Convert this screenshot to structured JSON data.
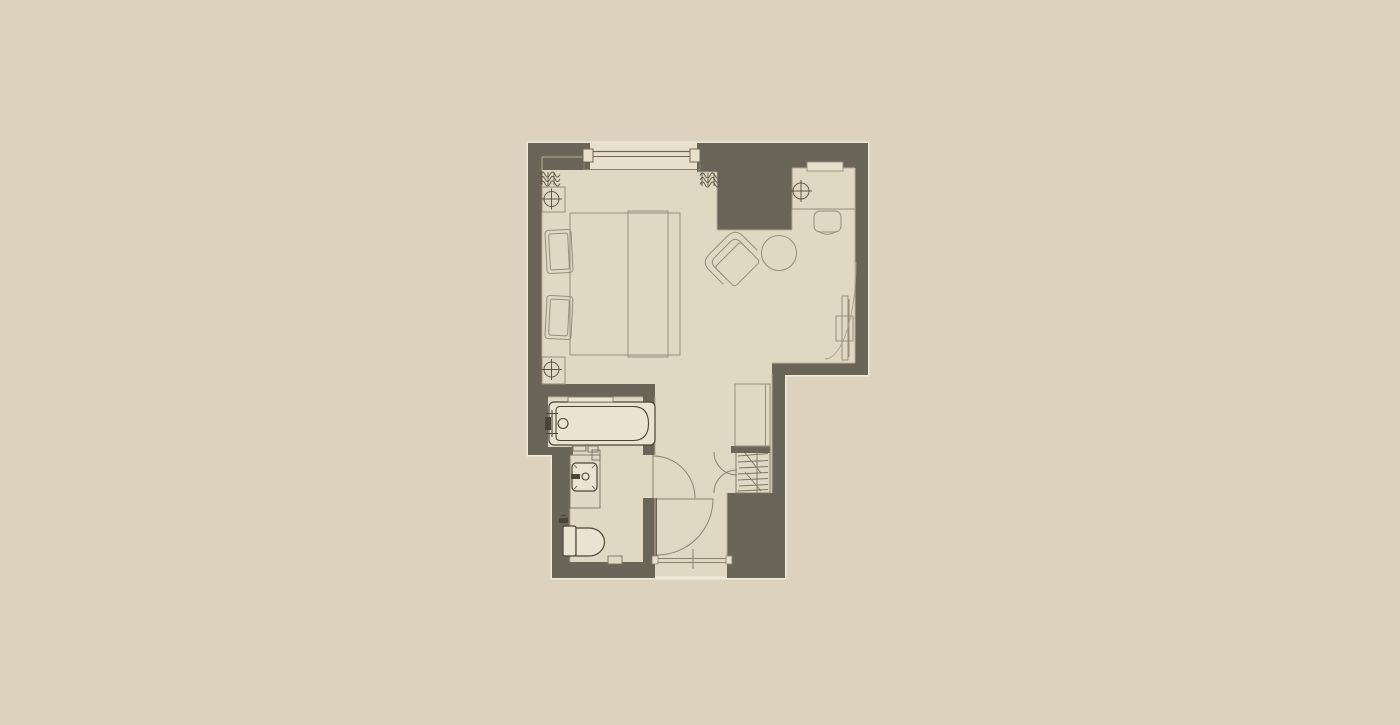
{
  "title": "Hotel guest room floor plan",
  "colors": {
    "bg": "#dcd2bd",
    "floor": "#e1d8c4",
    "floor-light": "#e8e0cd",
    "fixture": "#eae3d2",
    "wall": "#6b6459",
    "outline": "#efe9d8",
    "line": "#968c7a",
    "line-dark": "#4a4438",
    "door": "#8a8071",
    "detail": "#7a7162",
    "glyph": "#5f5748",
    "hairline": "#b7ac96"
  },
  "rooms": [
    {
      "name": "bedroom"
    },
    {
      "name": "bathroom"
    },
    {
      "name": "entry-hall"
    }
  ],
  "elements": {
    "bedroom": [
      "window",
      "curtain-left",
      "curtain-right",
      "nightstand-top",
      "table-lamp-top",
      "bed",
      "pillows",
      "bed-runner",
      "nightstand-bottom",
      "table-lamp-bottom",
      "desk",
      "desk-lamp",
      "desk-chair",
      "desk-shelf",
      "armchair",
      "round-table",
      "tv-panel",
      "tv-swivel-arc"
    ],
    "bathroom": [
      "bathtub",
      "tub-faucet",
      "tub-shelf",
      "tub-controls",
      "vanity-counter",
      "sink",
      "sink-faucet",
      "toiletries",
      "toilet",
      "bathroom-door",
      "wall-niche"
    ],
    "entry-hall": [
      "wardrobe",
      "linen-closet",
      "closet-shelves",
      "bifold-doors",
      "entry-door",
      "entry-threshold"
    ]
  }
}
